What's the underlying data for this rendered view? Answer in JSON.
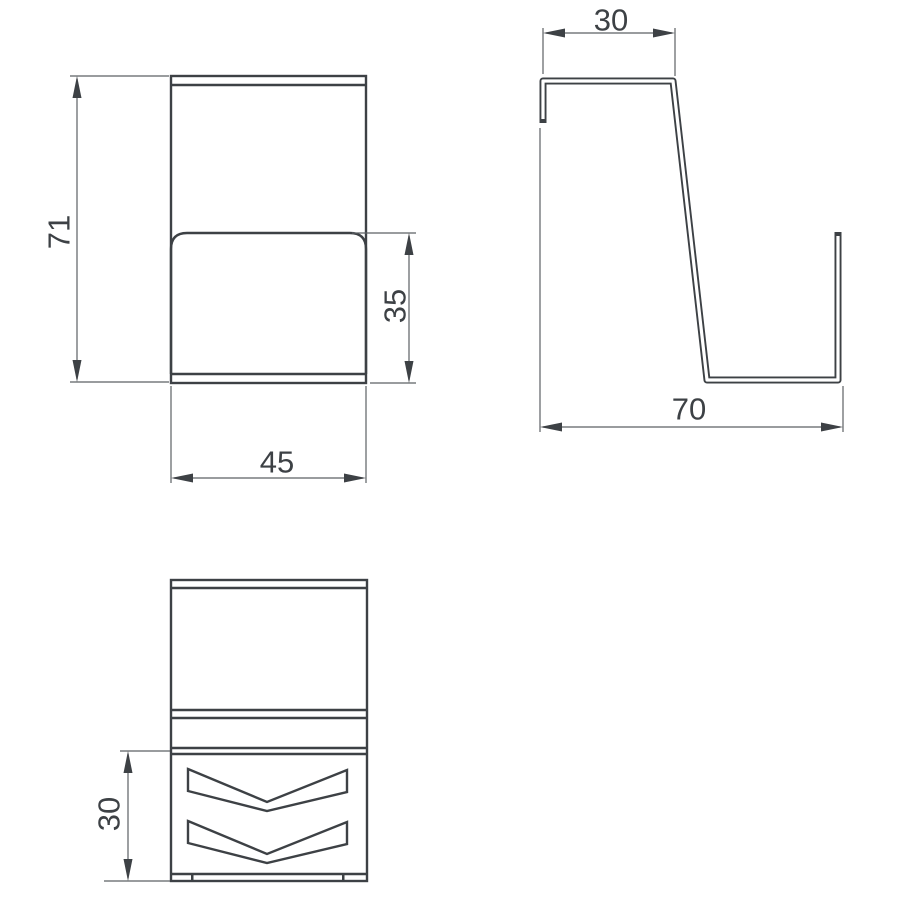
{
  "dimensions": {
    "front_height": "71",
    "front_inner_height": "35",
    "front_width": "45",
    "side_top_width": "30",
    "side_bottom_depth": "70",
    "bottom_section_height": "30"
  },
  "colors": {
    "background": "#ffffff",
    "line": "#3d4145",
    "dim": "#5c6064",
    "text": "#3d4145"
  }
}
